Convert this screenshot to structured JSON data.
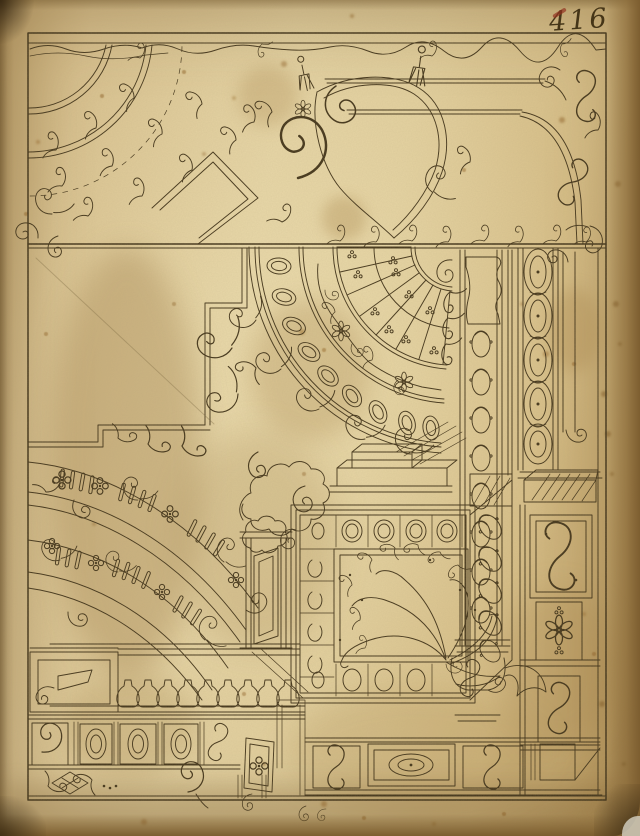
{
  "page": {
    "number": "416"
  },
  "colors": {
    "paper": "#ddc794",
    "paper_light": "#ecdcb0",
    "paper_edge": "#8a6a3a",
    "paper_dark": "#6f5328",
    "ink": "#43351b",
    "ink_faint": "#7a663f",
    "stain": "#a9823f",
    "red_mark": "#93321f"
  },
  "figure": {
    "kind": "pen-and-ink ornament drawing, aged paper",
    "elements": [
      "border-frame",
      "top-wave-vine",
      "upper-scroll-study",
      "corner-fan-arcs",
      "cartouche",
      "tassels",
      "coffered-fan-upper-right",
      "lattice-with-florets",
      "oval-coffer-band",
      "stepped-cornice",
      "husk-column",
      "guilloche-pilaster",
      "hatched-corbel",
      "square-coffered-panel",
      "foliate-plume",
      "cloud-puffs",
      "fluted-arch-bands",
      "balustrade",
      "oval-panel-frieze",
      "lozenge-x-ornament",
      "scroll-panels",
      "rosette-panel",
      "page-number-inscription"
    ]
  }
}
